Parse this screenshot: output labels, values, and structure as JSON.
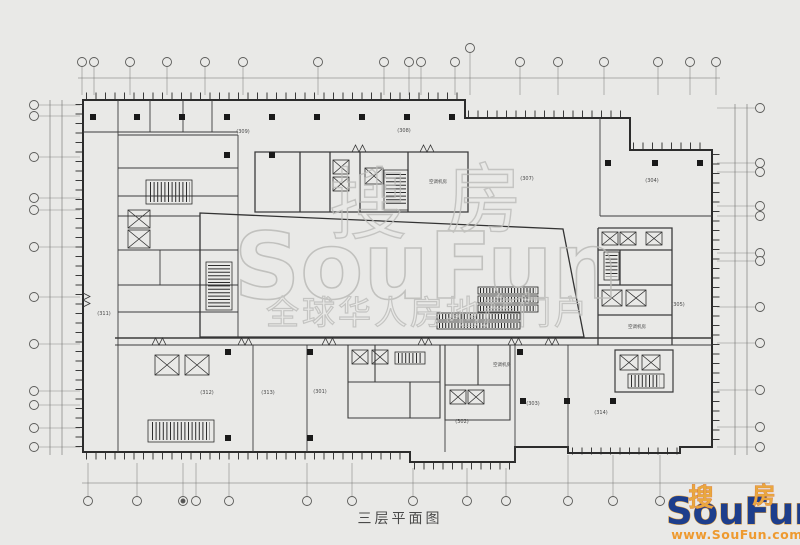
{
  "colors": {
    "background": "#e9e9e7",
    "line": "#333333",
    "watermark_gray": "#bcbcb9",
    "logo_blue": "#1d3e8c",
    "logo_gold": "#e8a43c",
    "logo_orange": "#ee9a2f"
  },
  "title": {
    "text": "三层平面图"
  },
  "watermark": {
    "char1": "搜",
    "char2": "房",
    "name": "SouFun",
    "slogan": "全球华人房地产门户"
  },
  "logo": {
    "cn1": "搜",
    "cn2": "房",
    "name": "SouFun",
    "url": "www.SouFun.com"
  },
  "plan": {
    "rooms": [
      {
        "label": "(309)"
      },
      {
        "label": "(308)"
      },
      {
        "label": "(307)"
      },
      {
        "label": "(304)"
      },
      {
        "label": "(305)"
      },
      {
        "label": "(311)"
      },
      {
        "label": "(312)"
      },
      {
        "label": "(313)"
      },
      {
        "label": "(301)"
      },
      {
        "label": "(302)"
      },
      {
        "label": "(303)"
      },
      {
        "label": "(314)"
      }
    ],
    "mech": [
      {
        "label": "空调机房"
      },
      {
        "label": "空调机房"
      },
      {
        "label": "空调机房"
      }
    ]
  }
}
